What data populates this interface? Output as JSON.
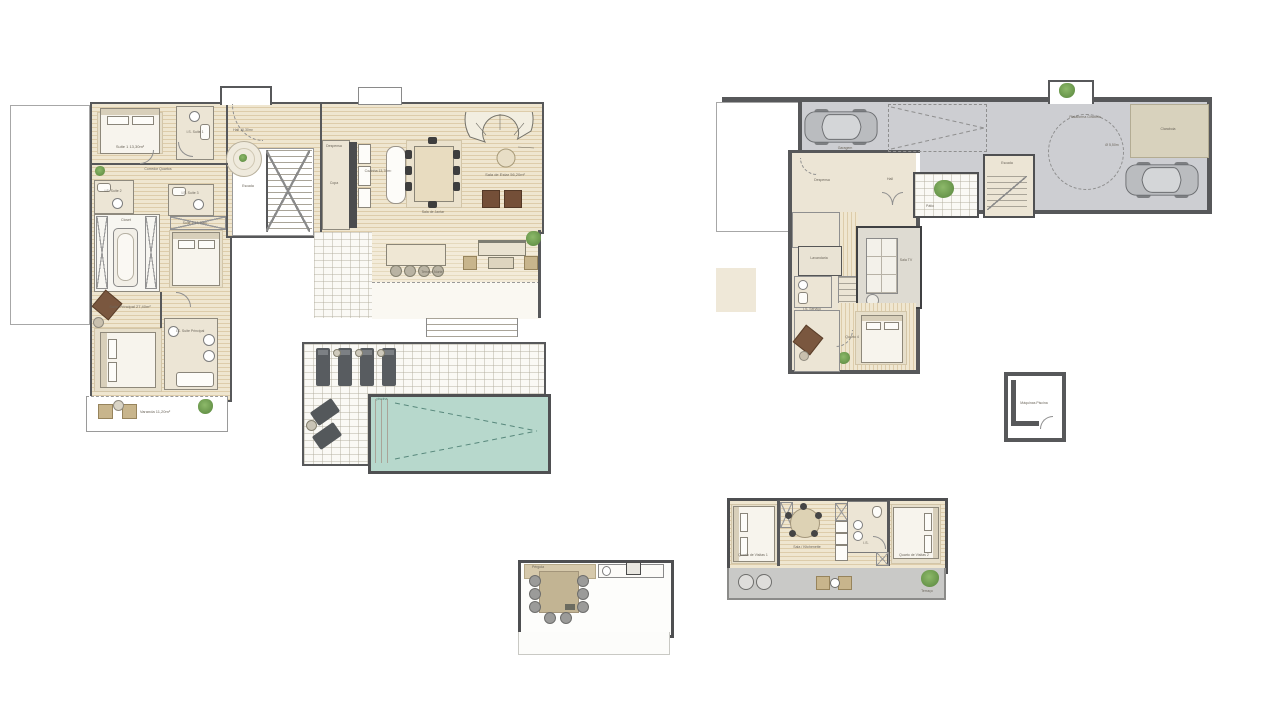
{
  "sheet_background": "#ffffff",
  "colors": {
    "wall": "#57585a",
    "wood_floor": "#eee3cb",
    "wood_line": "#ddccaa",
    "tile": "#faf9f5",
    "bath_beige": "#ece5d5",
    "garage_floor": "#cdced2",
    "pool_water": "#b7d8cc",
    "pool_dash": "#58887c",
    "canopy_tan": "#d0c3a3",
    "furniture_dark": "#585c60",
    "furniture_brown": "#7a573f",
    "plant_green": "#6f9d50",
    "terrace_gray": "#c9c9c7",
    "skylight_beige": "#d8d2bd"
  },
  "icons": {
    "car": "car-icon",
    "bed": "bed-icon",
    "sofa": "sofa-icon",
    "plant": "plant-icon",
    "lounger": "lounger-icon",
    "stairs": "stairs-icon",
    "bathtub": "bathtub-icon",
    "dining-table": "dining-table-icon",
    "turntable": "turntable-circle"
  },
  "plans": {
    "main_floor": {
      "name": "Piso Principal",
      "labels": {
        "hall": "Hall 10,30m²",
        "suite1": "Suite 1 13,30m²",
        "is_suite1": "I.S. Suite 1",
        "corredor": "Corredor Quartos",
        "is_suite2": "I.S. Suite 2",
        "is_suite3": "I.S. Suite 3",
        "closet": "Closet",
        "suite2": "Suite 2 13,10m²",
        "suite_principal": "Suite Principal 27,40m²",
        "is_principal": "I.S. Suite Principal",
        "varanda": "Varanda 11,20m²",
        "escada": "Escada",
        "despensa": "Despensa",
        "copa": "Copa",
        "cozinha": "Cozinha 13,70m²",
        "sala_jantar": "Sala de Jantar",
        "sala_estar": "Sala de Estar 56,20m²",
        "terraco": "Terraço Norte",
        "piscina": "piscina"
      }
    },
    "garage_floor": {
      "name": "Piso Garagem",
      "labels": {
        "garagem": "Garagem",
        "plataforma": "Plataforma Giratória",
        "raio": "Ø 5,50m",
        "claraboia": "Claraboia",
        "despensa": "Despensa",
        "hall": "Hall",
        "lavandaria": "Lavandaria",
        "is_servico": "I.S. Serviço",
        "sala_tv": "Sala TV",
        "quarto": "Quarto 4",
        "escada": "Escada",
        "patio": "Pátio"
      }
    },
    "pool_plant_room": {
      "label": "Máquinas Piscina"
    },
    "roof_terrace": {
      "labels": {
        "pergola": "Pérgola"
      }
    },
    "guest_annex": {
      "labels": {
        "quarto1": "Quarto de Visitas 1",
        "sala": "Sala / Kitchenette",
        "is": "I.S.",
        "quarto2": "Quarto de Visitas 2",
        "terraco": "Terraço"
      }
    }
  }
}
